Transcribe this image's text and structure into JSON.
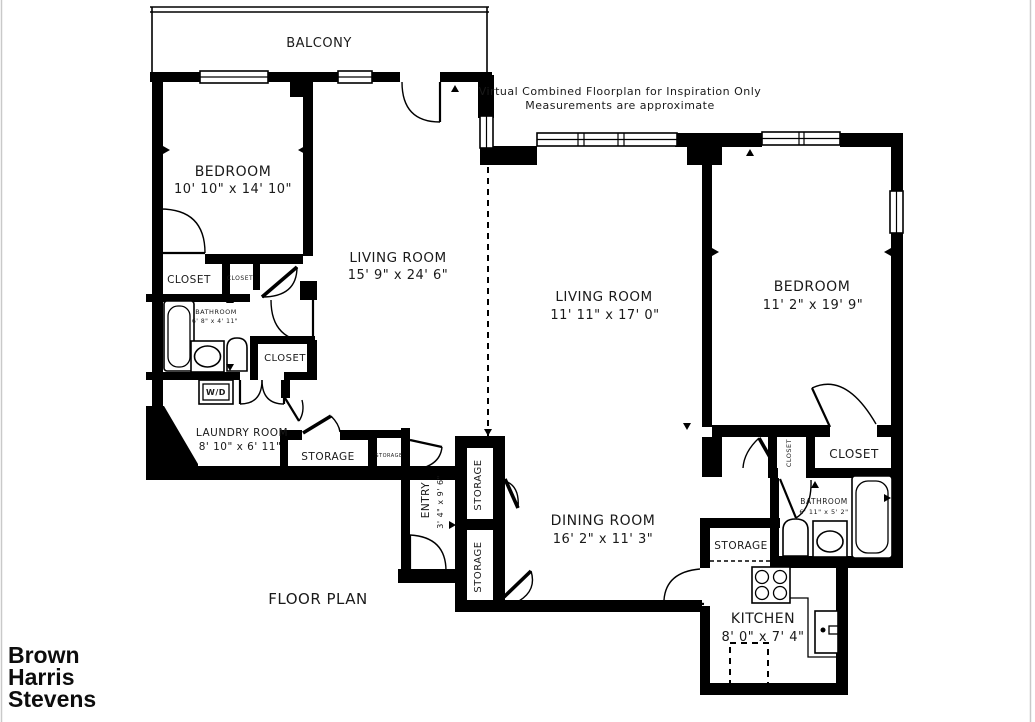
{
  "disclaimer": {
    "line1": "Virtual Combined Floorplan for Inspiration Only",
    "line2": "Measurements are approximate"
  },
  "plan_title": "FLOOR PLAN",
  "logo": {
    "line1": "Brown",
    "line2": "Harris",
    "line3": "Stevens"
  },
  "rooms": {
    "balcony": {
      "name": "BALCONY"
    },
    "bedroom_left": {
      "name": "BEDROOM",
      "dims": "10' 10\" x 14' 10\""
    },
    "living_room_left": {
      "name": "LIVING ROOM",
      "dims": "15' 9\" x 24' 6\""
    },
    "living_room_right": {
      "name": "LIVING ROOM",
      "dims": "11' 11\" x 17' 0\""
    },
    "bedroom_right": {
      "name": "BEDROOM",
      "dims": "11' 2\" x 19' 9\""
    },
    "dining_room": {
      "name": "DINING ROOM",
      "dims": "16' 2\" x 11' 3\""
    },
    "kitchen": {
      "name": "KITCHEN",
      "dims": "8' 0\" x 7' 4\""
    },
    "bathroom_left": {
      "name": "BATHROOM",
      "dims": "6' 8\" x 4' 11\""
    },
    "bathroom_right": {
      "name": "BATHROOM",
      "dims": "6' 11\" x 5' 2\""
    },
    "laundry_room": {
      "name": "LAUNDRY ROOM",
      "dims": "8' 10\" x 6' 11\""
    },
    "entry": {
      "name": "ENTRY",
      "dims": "3' 4\" x 9' 6\""
    },
    "closet_bedroom_left_big": "CLOSET",
    "closet_bedroom_left_small": "CLOSET",
    "closet_hall_left": "CLOSET",
    "closet_bedroom_right_small": "CLOSET",
    "closet_bedroom_right_big": "CLOSET",
    "wd": "W/D",
    "storage_laundry": "STORAGE",
    "storage_laundry_small": "STORAGE",
    "storage_hall_top": "STORAGE",
    "storage_hall_bottom": "STORAGE",
    "storage_kitchen": "STORAGE"
  }
}
